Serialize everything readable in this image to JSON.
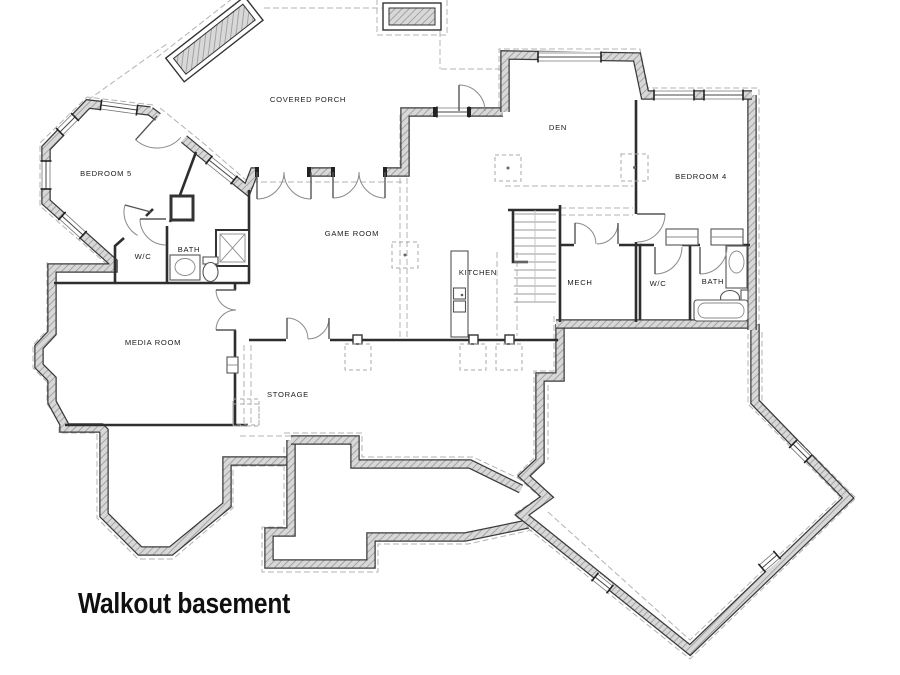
{
  "title": "Walkout basement",
  "rooms": [
    {
      "id": "bedroom5",
      "label": "BEDROOM 5"
    },
    {
      "id": "wc-left",
      "label": "W/C"
    },
    {
      "id": "bath-left",
      "label": "BATH"
    },
    {
      "id": "covered-porch",
      "label": "COVERED PORCH"
    },
    {
      "id": "game-room",
      "label": "GAME ROOM"
    },
    {
      "id": "kitchen",
      "label": "KITCHEN"
    },
    {
      "id": "den",
      "label": "DEN"
    },
    {
      "id": "bedroom4",
      "label": "BEDROOM 4"
    },
    {
      "id": "mech",
      "label": "MECH"
    },
    {
      "id": "wc-right",
      "label": "W/C"
    },
    {
      "id": "bath-right",
      "label": "BATH"
    },
    {
      "id": "media-room",
      "label": "MEDIA ROOM"
    },
    {
      "id": "storage",
      "label": "STORAGE"
    }
  ],
  "colors": {
    "wall_hatch": "#d8d8d8",
    "wall_edge": "#3a3a3a",
    "dashed": "#b3b3b3"
  }
}
